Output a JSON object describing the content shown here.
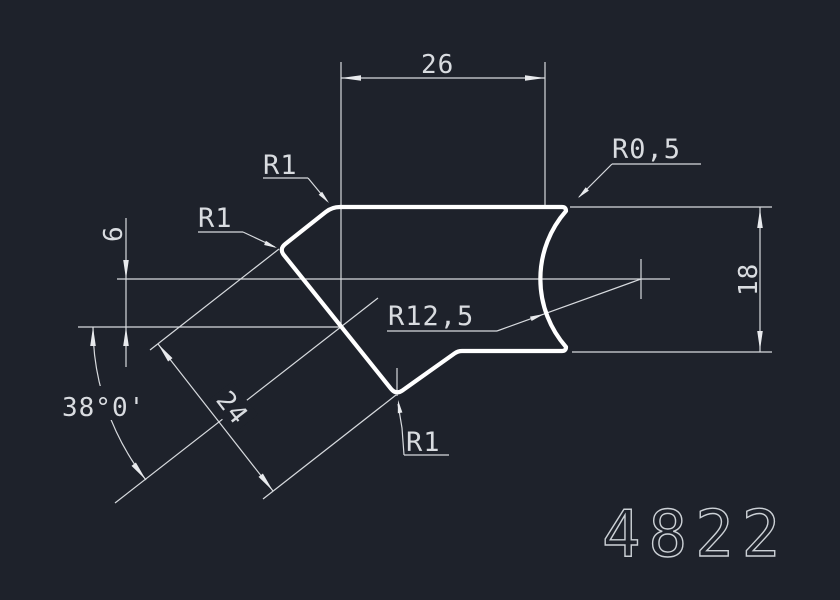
{
  "drawing": {
    "part_number": "4822",
    "dimensions": {
      "top_width": "26",
      "right_height": "18",
      "left_offset": "6",
      "diagonal_width": "24",
      "angle": "38°0'"
    },
    "radius_labels": {
      "top_left_corner": "R1",
      "left_corner": "R1",
      "bottom_corner": "R1",
      "top_right_corner": "R0,5",
      "concave_arc": "R12,5"
    },
    "colors": {
      "background": "#1e222b",
      "profile_line": "#ffffff",
      "thin_line": "#d7dade",
      "text": "#d9dce0"
    }
  }
}
